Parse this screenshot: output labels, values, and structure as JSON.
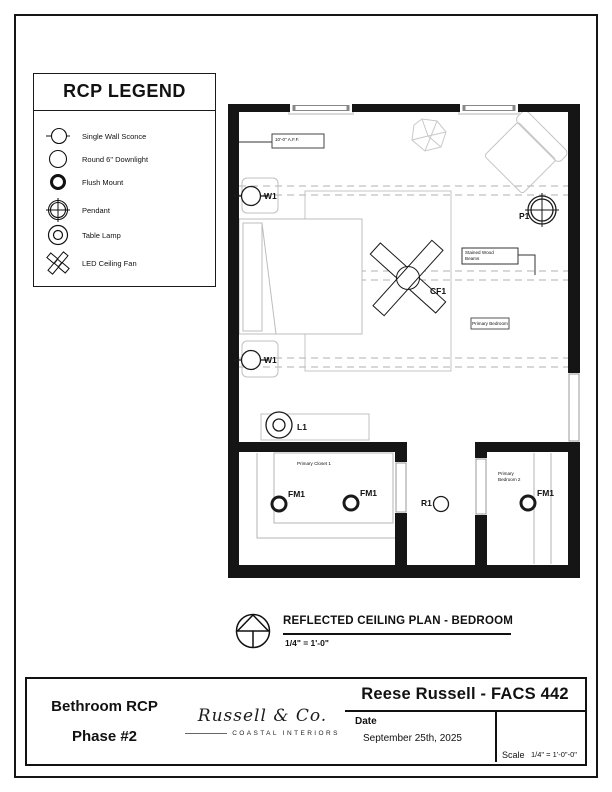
{
  "legend": {
    "title": "RCP LEGEND",
    "items": [
      {
        "icon": "single-wall-sconce-icon",
        "label": "Single Wall Sconce"
      },
      {
        "icon": "round-downlight-icon",
        "label": "Round 6\" Downlight"
      },
      {
        "icon": "flush-mount-icon",
        "label": "Flush Mount"
      },
      {
        "icon": "pendant-icon",
        "label": "Pendant"
      },
      {
        "icon": "table-lamp-icon",
        "label": "Table Lamp"
      },
      {
        "icon": "led-ceiling-fan-icon",
        "label": "LED Ceiling Fan"
      }
    ]
  },
  "plan": {
    "labels": {
      "w1": "W1",
      "p1": "P1",
      "cf1": "CF1",
      "l1": "L1",
      "fm1": "FM1",
      "r1": "R1"
    },
    "annotations": {
      "ceiling_height": "10'-0\" A.F.F.",
      "beams": "Stained Wood Beams",
      "primary_bedroom": "Primary Bedroom",
      "primary_closet": "Primary Closet 1",
      "primary_bedroom_2": "Primary Bedroom 2"
    }
  },
  "drawing_title": {
    "title": "REFLECTED CEILING PLAN - BEDROOM",
    "scale": "1/4\" = 1'-0\""
  },
  "title_block": {
    "project_line1": "Bethroom RCP",
    "project_line2": "Phase #2",
    "logo_script": "Russell & Co.",
    "logo_subtitle": "COASTAL INTERIORS",
    "header": "Reese Russell - FACS 442",
    "date_label": "Date",
    "date_value": "September 25th, 2025",
    "scale_label": "Scale",
    "scale_value": "1/4\" = 1'-0\"-0\""
  },
  "colors": {
    "line": "#111111",
    "furniture": "#bdbdbd",
    "beam_dash": "#b0b0b0"
  }
}
